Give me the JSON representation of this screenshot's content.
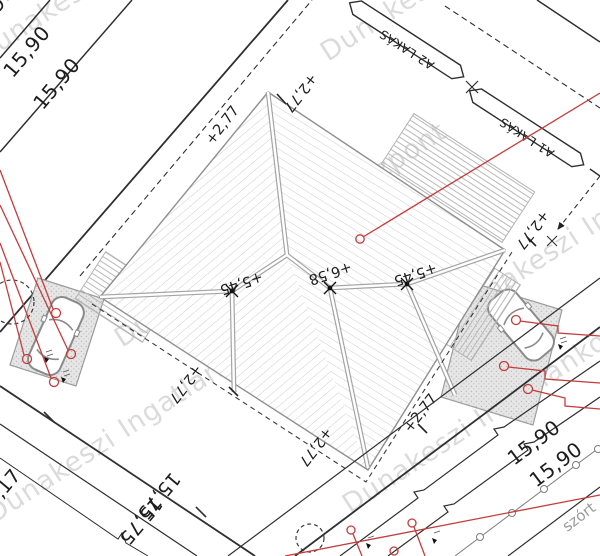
{
  "watermark": {
    "text": "Dunakeszi Ingatlanközpont",
    "color": "#c9c9c9"
  },
  "unit_labels": {
    "a2": "A2 LAKÁS",
    "a1": "A1 LAKÁS"
  },
  "plot_dimensions": {
    "nw": [
      "15,90",
      "15,90",
      "15,90"
    ],
    "sw": [
      "15,75",
      "15,75",
      "16,17"
    ],
    "se": [
      "15,90",
      "15,90"
    ]
  },
  "roof": {
    "ridge_heights": [
      "+5,45",
      "+6,58",
      "+5,45"
    ],
    "eave_labels": [
      "+2,77",
      "+2,77",
      "+2,77",
      "+2,77",
      "+2,77",
      "+2,77"
    ]
  },
  "street": {
    "surface_label": "szórt"
  },
  "colors": {
    "leader_red": "#c43c3c",
    "boundary_line": "#2f2f2f",
    "roof_line": "#8f8f8f",
    "watermark": "#c9c9c9"
  }
}
